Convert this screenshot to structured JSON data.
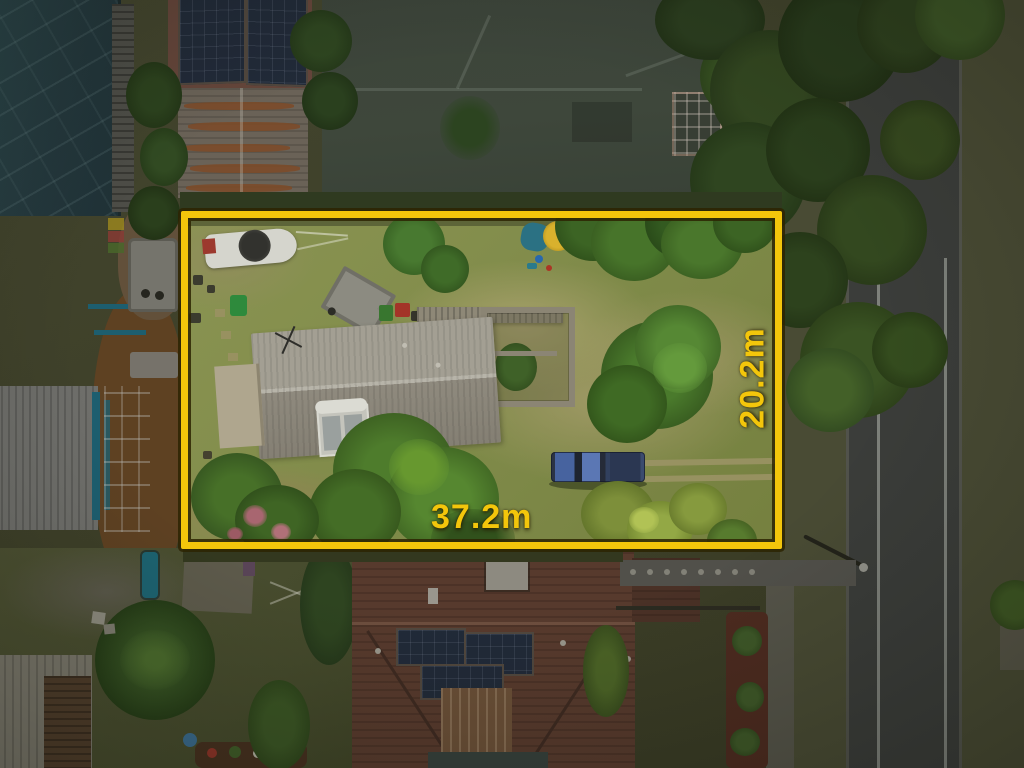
{
  "title": "Aerial drone photo of residential lot with boundary overlay",
  "overlay": {
    "frontage_label": "37.2m",
    "depth_label": "20.2m",
    "boundary_color": "#F3C60B"
  },
  "scene": {
    "lot_grass_color": "#85904F",
    "outside_dim_tone": "rgba(8,10,4,0.45)",
    "road_color": "#3B3D3A",
    "cottage_roof_color": "#9B978C",
    "neighbor_tiled_roof_color": "#573A2D",
    "neighbor_green_roof_color": "#3D453A",
    "truck_color": "#47639F",
    "objects": [
      "boat",
      "box-trailer",
      "pickup-truck",
      "solar-hot-water",
      "clothesline",
      "street",
      "palm-trees"
    ]
  }
}
